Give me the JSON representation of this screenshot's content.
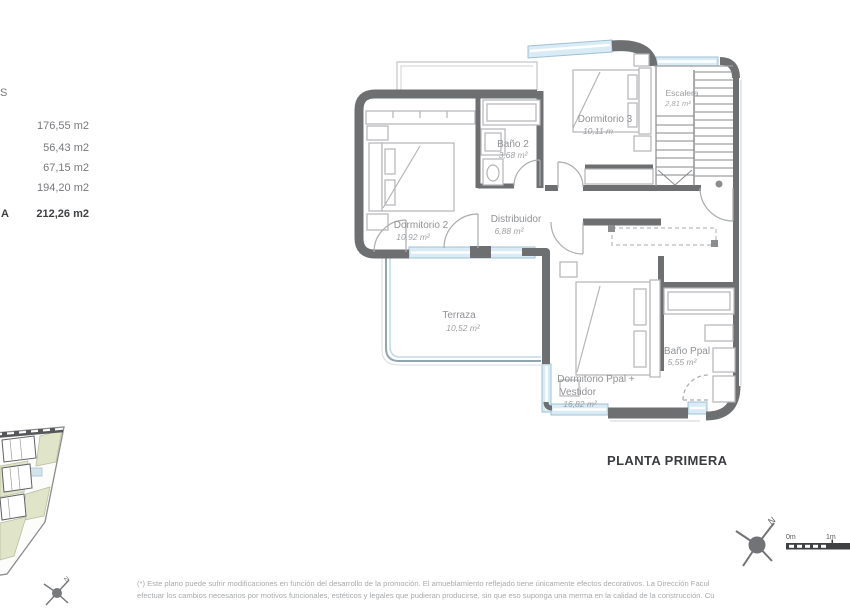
{
  "colors": {
    "wall": "#6e6f71",
    "window_fill": "#d9ebf4",
    "window_stroke": "#9fc0d2",
    "furniture_stroke": "#b3b5b7",
    "muted_text": "#77797c",
    "bold_text": "#3f4144",
    "label_text": "#8f9194",
    "footnote_text": "#a8aaac",
    "siteplan_green": "#e0e4c9",
    "siteplan_blue": "#d3e4ec"
  },
  "surfaces": {
    "header_fragment": "S",
    "rows": [
      {
        "value": "176,55 m2"
      },
      {
        "value": "56,43 m2"
      },
      {
        "value": "67,15 m2"
      },
      {
        "value": "194,20 m2"
      }
    ],
    "total_fragment": "A",
    "total_value": "212,26 m2"
  },
  "plan": {
    "title": "PLANTA PRIMERA",
    "rooms": [
      {
        "name": "Dormitorio 2",
        "area": "10,92 m²"
      },
      {
        "name": "Baño 2",
        "area": "3,68 m²"
      },
      {
        "name": "Dormitorio 3",
        "area": "10,11 m"
      },
      {
        "name": "Escalera",
        "area": "2,81 m²"
      },
      {
        "name": "Distribuidor",
        "area": "6,88 m²"
      },
      {
        "name": "Terraza",
        "area": "10,52 m²"
      },
      {
        "name": "Dormitorio Ppal +",
        "name_line2": "Vestidor",
        "area": "16,82 m²"
      },
      {
        "name": "Baño Ppal",
        "area": "5,55 m²"
      }
    ]
  },
  "scale_bar": {
    "label_start": "0m",
    "label_one": "1m"
  },
  "compass": {
    "label": "N"
  },
  "footnote": {
    "line1": "(*) Este plano puede sufrir modificaciones en función del desarrollo de la promoción. El amueblamiento reflejado tiene únicamente efectos decorativos. La Dirección Facul",
    "line2": "efectuar los cambios necesarios por motivos funcionales, estéticos y legales que pudieran producirse, sin que eso suponga una merma en la calidad de la construcción. Cu"
  }
}
